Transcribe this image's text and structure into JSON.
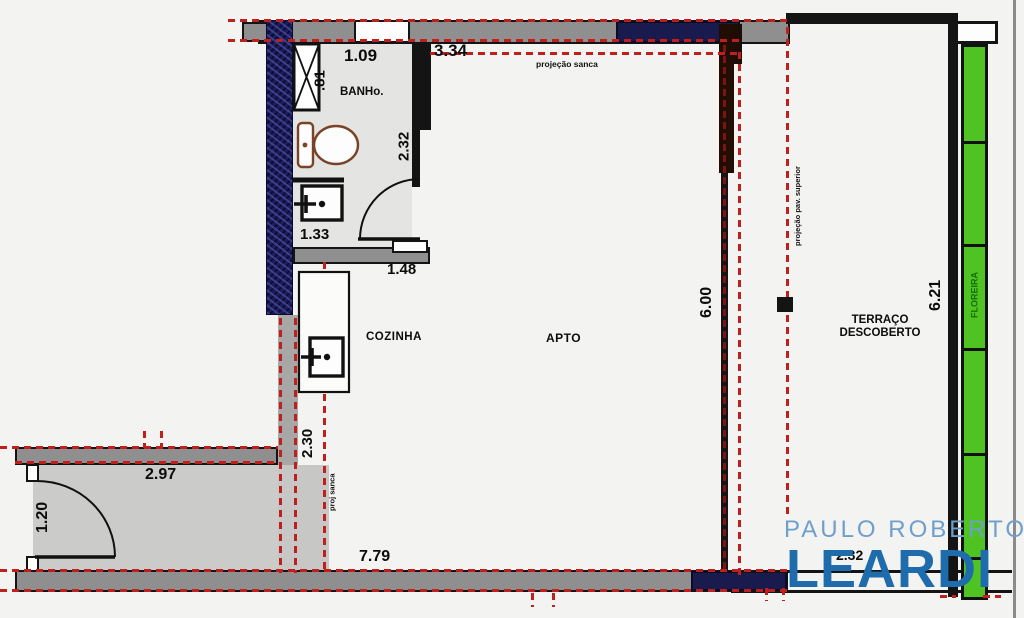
{
  "colors": {
    "dashed_projection_red": "#bf201d",
    "wall_gray": "#8f8f8f",
    "window_band_navy": "#191a4e",
    "hatched_wall_blue": "#1c1d5a",
    "planter_green": "#4ec321",
    "planter_text_green": "#156e08",
    "logo_light_blue": "#6f9fca",
    "logo_blue": "#1e6cab"
  },
  "plan": {
    "rooms": {
      "bathroom": "BANHo.",
      "kitchen": "COZINHA",
      "apartment": "APTO",
      "terrace": "TERRAÇO DESCOBERTO",
      "planter": "FLOREIRA"
    },
    "dimensions": {
      "bath_width": "1.09",
      "shaft_width": ".81",
      "bath_length": "2.32",
      "sink_wall": "1.33",
      "bath_door_wall": "1.48",
      "top_span": "3.34",
      "kitchen_depth": "2.30",
      "hall_width": "2.97",
      "hall_depth": "1.20",
      "bottom_span": "7.79",
      "apto_depth": "6.00",
      "terrace_depth": "6.21",
      "terrace_width": "2.32"
    },
    "annotations": {
      "ceiling_projection": "projeção sanca",
      "ceiling_projection_short": "proj sanca",
      "upper_floor_projection": "projeção pav. superior"
    }
  },
  "watermark": {
    "name": "PAULO ROBERTO",
    "brand": "LEARDI"
  }
}
